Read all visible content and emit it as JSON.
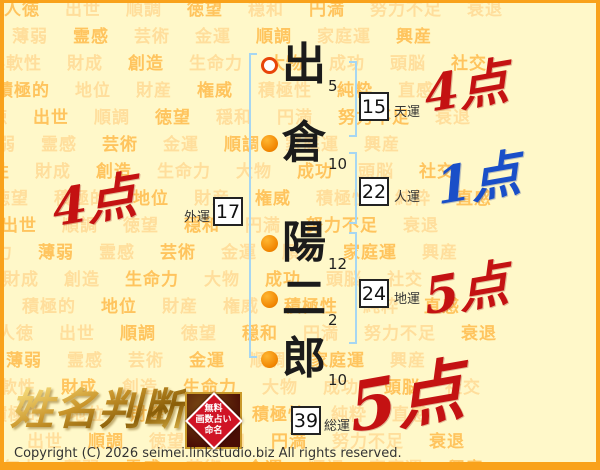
{
  "background": {
    "words": [
      "人徳",
      "出世",
      "順調",
      "徳望",
      "穏和",
      "円満",
      "努力不足",
      "衰退",
      "無力",
      "薄弱",
      "霊感",
      "芸術",
      "金運",
      "順調",
      "家庭運",
      "興産",
      "柔軟性",
      "財成",
      "創造",
      "生命力",
      "大物",
      "成功",
      "頭脳",
      "社交",
      "徳望",
      "積極的",
      "地位",
      "財産",
      "権威",
      "積極性",
      "純粋",
      "直感"
    ],
    "color_light": "#FFDE9C",
    "color_dark": "#FFC45E"
  },
  "name": {
    "characters": [
      {
        "char": "出",
        "strokes": 5,
        "marker": "open"
      },
      {
        "char": "倉",
        "strokes": 10,
        "marker": "filled"
      },
      {
        "char": "陽",
        "strokes": 12,
        "marker": "filled"
      },
      {
        "char": "二",
        "strokes": 2,
        "marker": "filled"
      },
      {
        "char": "郎",
        "strokes": 10,
        "marker": "filled"
      }
    ]
  },
  "fortunes": [
    {
      "value": 15,
      "label": "天運",
      "points": "4点",
      "points_color": "#C41212"
    },
    {
      "value": 22,
      "label": "人運",
      "points": "1点",
      "points_color": "#1A4FC8"
    },
    {
      "value": 24,
      "label": "地運",
      "points": "5点",
      "points_color": "#C41212"
    },
    {
      "value": 17,
      "label": "外運",
      "points": "4点",
      "points_color": "#C41212"
    },
    {
      "value": 39,
      "label": "総運",
      "points": "5点",
      "points_color": "#C41212"
    }
  ],
  "logo": {
    "title": "姓名判断",
    "seal_lines": [
      "無料",
      "画数占い",
      "命名"
    ]
  },
  "footer": {
    "copyright": "Copyright (C) 2026 seimei.linkstudio.biz All rights reserved.",
    "accent_color": "#F9A21B"
  }
}
